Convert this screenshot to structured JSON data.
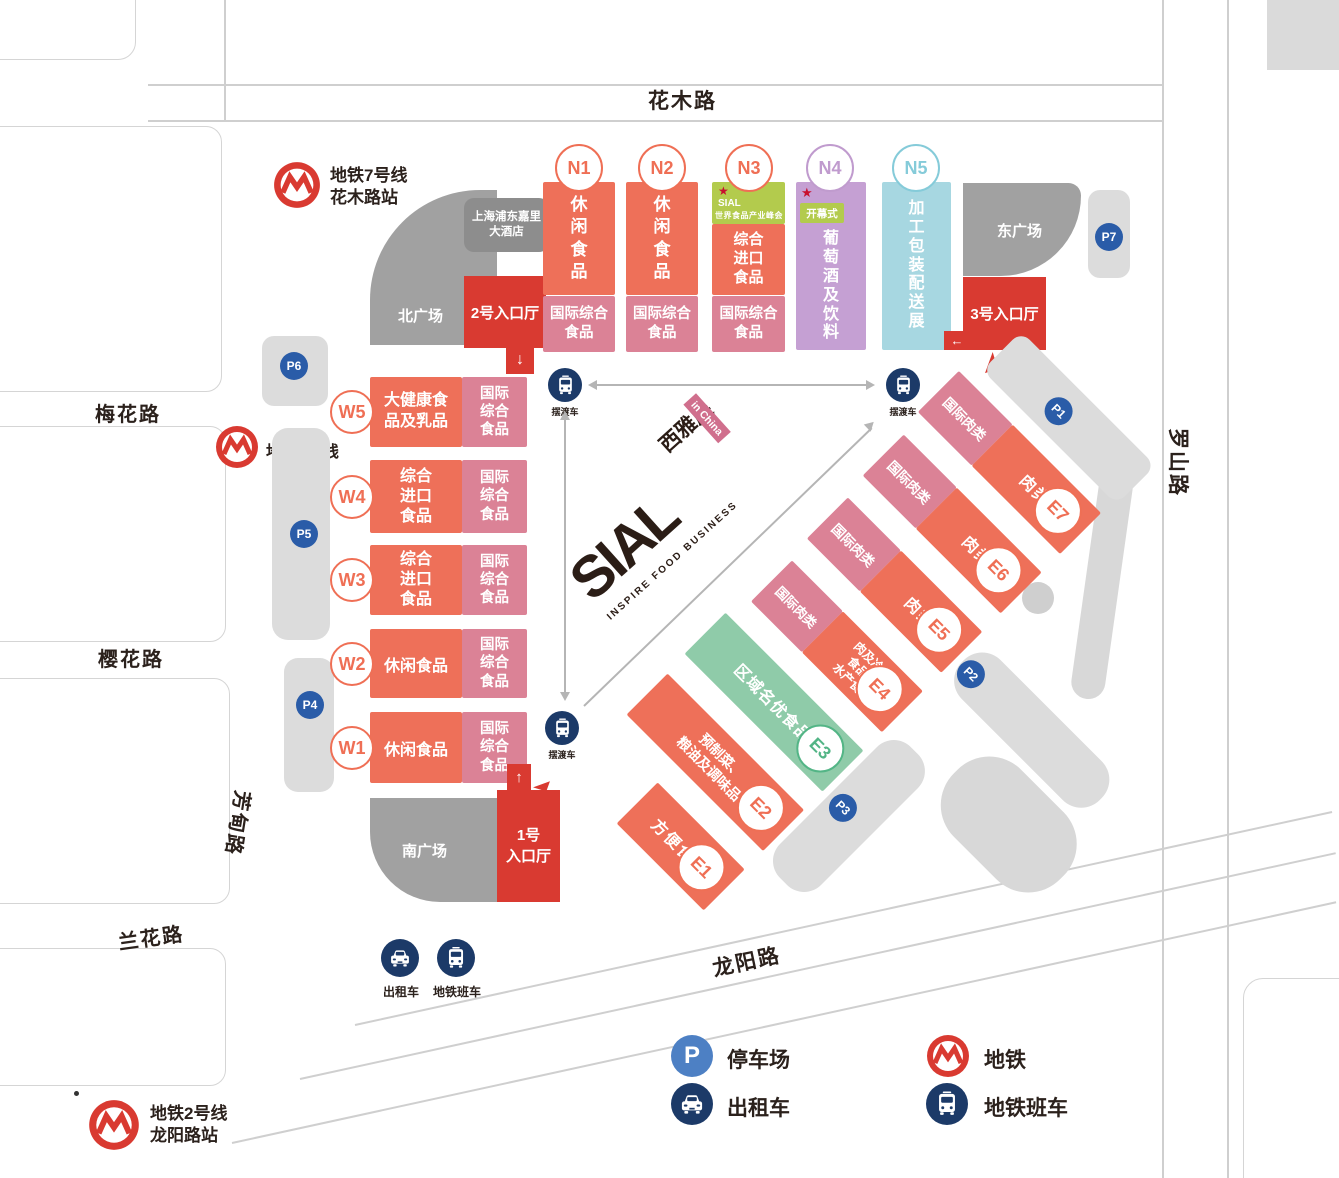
{
  "roads": {
    "top": "花木路",
    "right": "罗山路",
    "bottom": "龙阳路",
    "left_1": "梅花路",
    "left_2": "樱花路",
    "left_3": "兰花路",
    "left_4": "芳甸路"
  },
  "metro": {
    "line7_station": "地铁7号线\n花木路站",
    "line7": "地铁7号线",
    "line2_station": "地铁2号线\n龙阳路站"
  },
  "plazas": {
    "north": "北广场",
    "south": "南广场",
    "east": "东广场",
    "hotel": "上海浦东嘉里\n大酒店"
  },
  "entrances": {
    "hall1": "1号\n入口厅",
    "hall2": "2号入口厅",
    "hall3": "3号入口厅"
  },
  "halls": {
    "north": [
      {
        "id": "N1",
        "main": "休\n闲\n食\n品",
        "base": "国际综合\n食品"
      },
      {
        "id": "N2",
        "main": "休\n闲\n食\n品",
        "base": "国际综合\n食品"
      },
      {
        "id": "N3",
        "star": "★",
        "brand": "SIAL",
        "summit": "世界食品产业峰会",
        "main": "综合\n进口\n食品",
        "base": "国际综合\n食品"
      },
      {
        "id": "N4",
        "star": "★",
        "ceremony": "开幕式",
        "main": "葡\n萄\n酒\n及\n饮\n料"
      },
      {
        "id": "N5",
        "main": "加\n工\n包\n装\n配\n送\n展"
      }
    ],
    "west": [
      {
        "id": "W5",
        "main": "大健康食\n品及乳品",
        "side": "国际\n综合\n食品"
      },
      {
        "id": "W4",
        "main": "综合\n进口\n食品",
        "side": "国际\n综合\n食品"
      },
      {
        "id": "W3",
        "main": "综合\n进口\n食品",
        "side": "国际\n综合\n食品"
      },
      {
        "id": "W2",
        "main": "休闲食品",
        "side": "国际\n综合\n食品"
      },
      {
        "id": "W1",
        "main": "休闲食品",
        "side": "国际\n综合\n食品"
      }
    ],
    "east": [
      {
        "id": "E7",
        "pink": "国际肉类",
        "main": "肉类"
      },
      {
        "id": "E6",
        "pink": "国际肉类",
        "main": "肉类"
      },
      {
        "id": "E5",
        "pink": "国际肉类",
        "main": "肉类"
      },
      {
        "id": "E4",
        "pink": "国际肉类",
        "main": "肉及冷冻\n食品、\n水产食品"
      },
      {
        "id": "E3",
        "main": "区域名优食品"
      },
      {
        "id": "E2",
        "main": "预制菜、\n粮油及调味品"
      },
      {
        "id": "E1",
        "main": "方便食品"
      }
    ]
  },
  "parking": [
    "P1",
    "P2",
    "P3",
    "P4",
    "P5",
    "P6",
    "P7"
  ],
  "shuttle_label": "摆渡车",
  "south_icons": {
    "taxi": "出租车",
    "metro_bus": "地铁班车"
  },
  "legend": {
    "parking": "停车场",
    "metro": "地铁",
    "taxi": "出租车",
    "metro_bus": "地铁班车",
    "p_letter": "P"
  },
  "logo": {
    "name": "SIAL",
    "tagline": "INSPIRE FOOD BUSINESS",
    "cn": "西雅展",
    "sub": "in China"
  },
  "colors": {
    "orange": "#EE7059",
    "pink": "#DB8296",
    "purple": "#C5A0D3",
    "cyan": "#A7D7E1",
    "hall_green": "#8FCBA9",
    "lime": "#B3CB4D",
    "red": "#D93A31",
    "navy": "#1C3A68",
    "badge_blue": "#2A5CA8",
    "legend_blue": "#4D80C4",
    "plaza_gray": "#A1A1A1",
    "strip_gray": "#DCDCDC",
    "text": "#2B211C"
  }
}
